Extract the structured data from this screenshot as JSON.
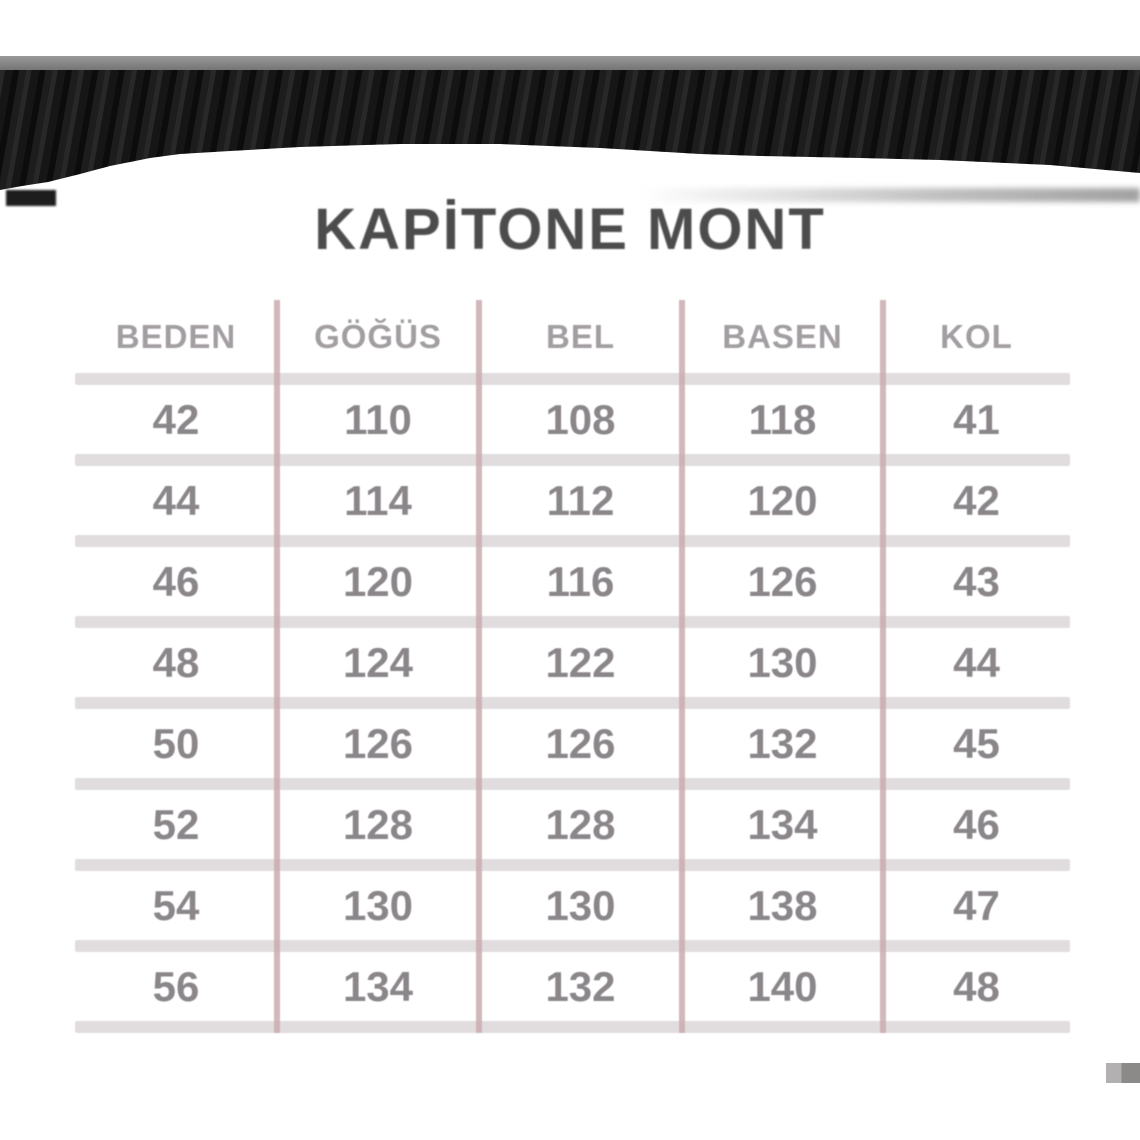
{
  "title": "KAPİTONE MONT",
  "banner": {
    "description": "black textured fabric band with wavy lower edge",
    "band_color": "#161616",
    "top_line_color": "#7e7e7e"
  },
  "table": {
    "headers": [
      "BEDEN",
      "GÖĞÜS",
      "BEL",
      "BASEN",
      "KOL"
    ],
    "rows": [
      [
        "42",
        "110",
        "108",
        "118",
        "41"
      ],
      [
        "44",
        "114",
        "112",
        "120",
        "42"
      ],
      [
        "46",
        "120",
        "116",
        "126",
        "43"
      ],
      [
        "48",
        "124",
        "122",
        "130",
        "44"
      ],
      [
        "50",
        "126",
        "126",
        "132",
        "45"
      ],
      [
        "52",
        "128",
        "128",
        "134",
        "46"
      ],
      [
        "54",
        "130",
        "130",
        "138",
        "47"
      ],
      [
        "56",
        "134",
        "132",
        "140",
        "48"
      ]
    ],
    "colors": {
      "header_text": "#a29ea2",
      "cell_text": "#8a868a",
      "column_divider": "#c9abaf",
      "row_divider": "#e1dddf"
    }
  },
  "chart_data": {
    "type": "table",
    "title": "KAPİTONE MONT",
    "columns": [
      "BEDEN",
      "GÖĞÜS",
      "BEL",
      "BASEN",
      "KOL"
    ],
    "rows": [
      [
        42,
        110,
        108,
        118,
        41
      ],
      [
        44,
        114,
        112,
        120,
        42
      ],
      [
        46,
        120,
        116,
        126,
        43
      ],
      [
        48,
        124,
        122,
        130,
        44
      ],
      [
        50,
        126,
        126,
        132,
        45
      ],
      [
        52,
        128,
        128,
        134,
        46
      ],
      [
        54,
        130,
        130,
        138,
        47
      ],
      [
        56,
        134,
        132,
        140,
        48
      ]
    ]
  }
}
